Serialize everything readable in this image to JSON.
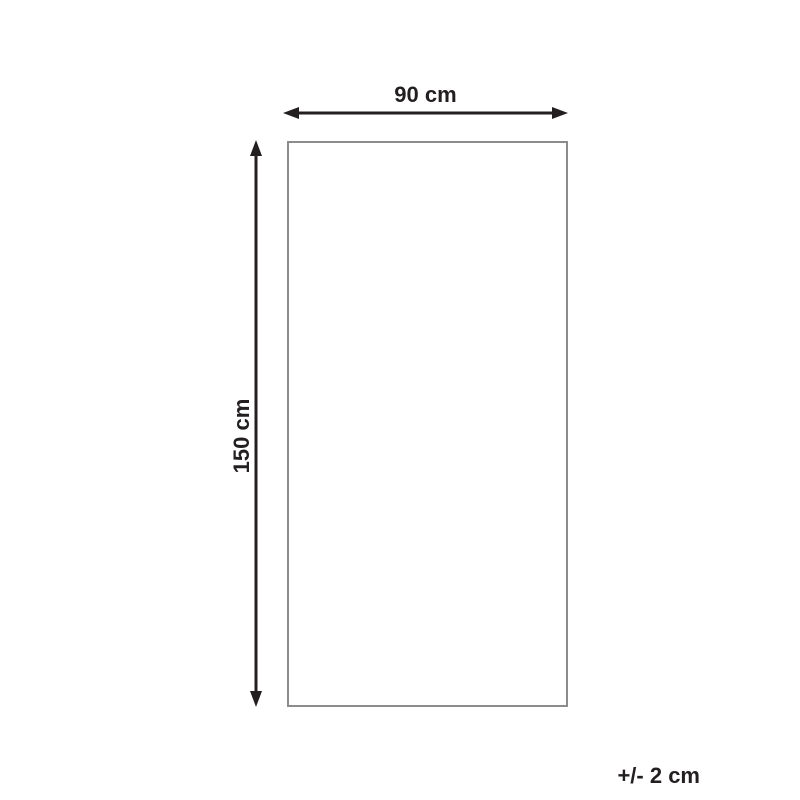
{
  "diagram": {
    "width_label": "90 cm",
    "height_label": "150 cm",
    "tolerance_label": "+/- 2 cm",
    "colors": {
      "arrow": "#231f20",
      "text": "#231f20",
      "outline": "#8c8c8c",
      "background": "#ffffff"
    }
  }
}
